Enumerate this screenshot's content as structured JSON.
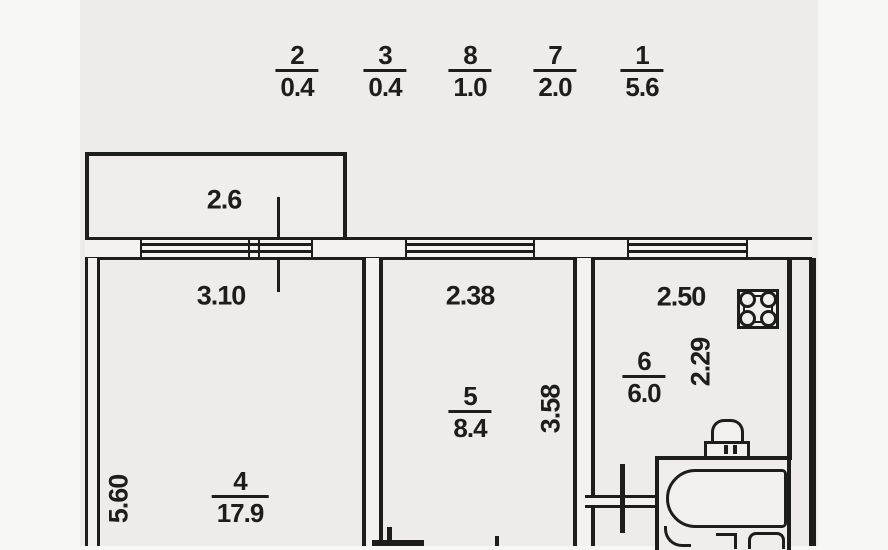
{
  "legend": {
    "items": [
      {
        "num": "2",
        "den": "0.4"
      },
      {
        "num": "3",
        "den": "0.4"
      },
      {
        "num": "8",
        "den": "1.0"
      },
      {
        "num": "7",
        "den": "2.0"
      },
      {
        "num": "1",
        "den": "5.6"
      }
    ]
  },
  "balcony": {
    "width": "2.6"
  },
  "room4": {
    "num": "4",
    "area": "17.9",
    "width": "3.10",
    "depth": "5.60"
  },
  "room5": {
    "num": "5",
    "area": "8.4",
    "width": "2.38",
    "depth": "3.58"
  },
  "room6": {
    "num": "6",
    "area": "6.0",
    "width": "2.50",
    "depth": "2.29"
  },
  "fixtures": {
    "stove": "stove",
    "toilet": "toilet",
    "bathtub": "bathtub"
  },
  "colors": {
    "line": "#1d1d1b",
    "paper": "#edeceb",
    "margin": "#f7f7f5"
  }
}
